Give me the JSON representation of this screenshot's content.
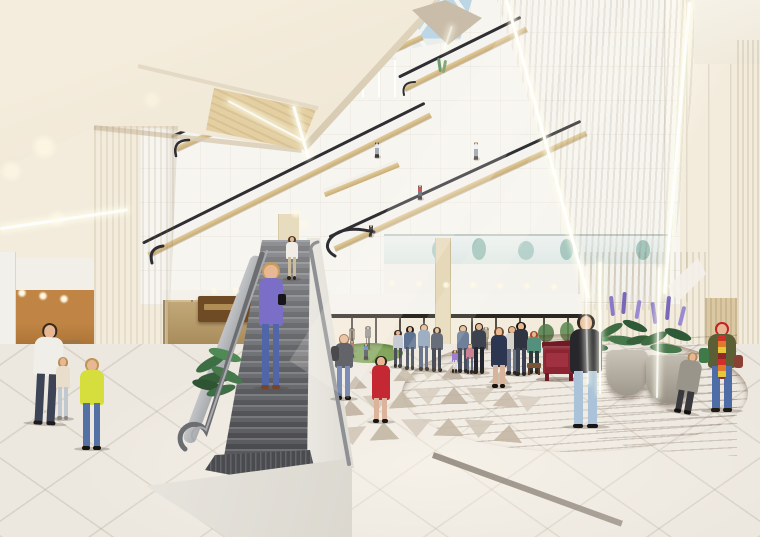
{
  "scene": {
    "type": "architectural-rendering",
    "subject": "shopping-mall-atrium-interior",
    "description": "Multi-storey mall atrium with skylight, criss-crossing escalators, central open staircase, tapering wood columns with LED strips, circular wood floor with red piano, planters with purple lupines, storefronts and shoppers",
    "palette": {
      "ceiling_cream": "#f0e8d8",
      "wall_white": "#f7f5f0",
      "wood_column": "#e0cda2",
      "wood_column_light": "#ead9b4",
      "escalator_gold": "#d9c291",
      "handrail_black": "#2f2f33",
      "stair_step_gray": "#5a5b60",
      "railing_gray": "#6b6d71",
      "floor_tile": "#ece7df",
      "triangle_taupe": "#c4b7a5",
      "wood_floor": "#9a6845",
      "piano_red": "#8c2431",
      "skylight_blue": "#bcd6e6",
      "plant_green": "#3e6b42",
      "flower_purple": "#8a7ac6",
      "led_white": "#ffffff"
    }
  },
  "people": [
    {
      "id": "balcony-person",
      "cx": 377,
      "hy": 142,
      "fy": 158,
      "top": "#e8ecee",
      "bottom": "#9aa4b0",
      "hair": "#3a332a",
      "o": 0.9
    },
    {
      "id": "escalator-person-dark",
      "cx": 371,
      "hy": 225,
      "fy": 237,
      "top": "#3c4250",
      "bottom": "#2c3038",
      "hair": "#20180f",
      "o": 0.9
    },
    {
      "id": "escalator-person-red",
      "cx": 420,
      "hy": 185,
      "fy": 200,
      "top": "#b02a30",
      "bottom": "#4e5668",
      "hair": "#2e2620",
      "o": 0.95
    },
    {
      "id": "escalator-person-white",
      "cx": 476,
      "hy": 142,
      "fy": 160,
      "top": "#eef0f2",
      "bottom": "#8a94a2",
      "hair": "#5a4a34",
      "o": 0.9
    },
    {
      "id": "store-fig-1",
      "cx": 352,
      "hy": 328,
      "fy": 352,
      "top": "#6a5a44",
      "bottom": "#3a342c",
      "hair": "#2a241c",
      "o": 0.55
    },
    {
      "id": "store-fig-2",
      "cx": 368,
      "hy": 326,
      "fy": 350,
      "top": "#44444c",
      "bottom": "#2e2a26",
      "hair": "#1e1a14",
      "o": 0.55
    },
    {
      "id": "store-fig-3",
      "cx": 486,
      "hy": 327,
      "fy": 350,
      "top": "#7a6a50",
      "bottom": "#4a4038",
      "hair": "#2c2016",
      "o": 0.5
    },
    {
      "id": "play-kid-1",
      "cx": 352,
      "hy": 341,
      "fy": 358,
      "top": "#c05a60",
      "bottom": "#5a6478",
      "hair": "#6a4a2a",
      "o": 0.9
    },
    {
      "id": "play-kid-2",
      "cx": 366,
      "hy": 344,
      "fy": 360,
      "top": "#5a80c0",
      "bottom": "#3e4454",
      "hair": "#3a2c1c",
      "o": 0.9
    },
    {
      "id": "crowd-1",
      "cx": 398,
      "hy": 330,
      "fy": 368,
      "top": "#c7ccd4",
      "bottom": "#4c505a",
      "hair": "#3a3027"
    },
    {
      "id": "crowd-2",
      "cx": 410,
      "hy": 326,
      "fy": 370,
      "top": "#5d7190",
      "bottom": "#3f4654",
      "hair": "#241e18"
    },
    {
      "id": "crowd-3",
      "cx": 424,
      "hy": 324,
      "fy": 371,
      "top": "#8fa2bc",
      "bottom": "#55607a",
      "hair": "#4a3b2a"
    },
    {
      "id": "crowd-4",
      "cx": 437,
      "hy": 327,
      "fy": 372,
      "top": "#4e5566",
      "bottom": "#2f333f",
      "hair": "#2c251d"
    },
    {
      "id": "crowd-kid-purple",
      "cx": 455,
      "hy": 350,
      "fy": 373,
      "top": "#9b80d2",
      "bottom": "#d9d9df",
      "hair": "#7a5a36"
    },
    {
      "id": "crowd-5",
      "cx": 463,
      "hy": 325,
      "fy": 373,
      "top": "#6e809a",
      "bottom": "#454d5e",
      "hair": "#1f1a14"
    },
    {
      "id": "crowd-kid-pink",
      "cx": 470,
      "hy": 344,
      "fy": 374,
      "top": "#c98291",
      "bottom": "#5b6579",
      "hair": "#8a6a42"
    },
    {
      "id": "crowd-6",
      "cx": 479,
      "hy": 323,
      "fy": 374,
      "top": "#3d424f",
      "bottom": "#23262e",
      "hair": "#2a2118"
    },
    {
      "id": "crowd-7",
      "cx": 512,
      "hy": 326,
      "fy": 375,
      "top": "#d6d3cc",
      "bottom": "#6b7284",
      "hair": "#5c4a30"
    },
    {
      "id": "crowd-8",
      "cx": 521,
      "hy": 322,
      "fy": 376,
      "top": "#2f3441",
      "bottom": "#3a4252",
      "hair": "#171310"
    },
    {
      "id": "woman-navy-skirt",
      "cx": 499,
      "hy": 327,
      "fy": 388,
      "top": "#2c3650",
      "bottom": "#d9b49a",
      "hair": "#6b4a2e",
      "shoe": "#14110e",
      "dress": true,
      "w": 18
    },
    {
      "id": "pianist",
      "cx": 534,
      "hy": 331,
      "fy": 374,
      "top": "#55907c",
      "bottom": "#2e3a3a",
      "hair": "#a34a28",
      "w": 15
    },
    {
      "id": "red-piano",
      "type": "piano",
      "x": 542,
      "y": 341,
      "w": 34,
      "body": "#8c2431",
      "dark": "#6e1b26",
      "front": "#a23344",
      "bench": "#7a5436"
    },
    {
      "id": "boy-backpack",
      "cx": 344,
      "hy": 334,
      "fy": 400,
      "top": "#3b3f48",
      "bottom": "#5a72a4",
      "hair": "#8a5f38",
      "shoe": "#15120e",
      "w": 20,
      "acc": [
        {
          "x": -3,
          "y": 12,
          "w": 8,
          "h": 15,
          "c": "#1d1d22",
          "r": 3
        }
      ]
    },
    {
      "id": "girl-red-dress",
      "cx": 381,
      "hy": 356,
      "fy": 423,
      "top": "#c32833",
      "bottom": "#dcb49c",
      "hair": "#2c2420",
      "shoe": "#1a1512",
      "dress": true,
      "w": 20
    },
    {
      "id": "stair-top-man",
      "cx": 292,
      "hy": 236,
      "fy": 280,
      "top": "#efede6",
      "bottom": "#cbbd9b",
      "hair": "#4a3a28",
      "shoe": "#2a2520"
    },
    {
      "id": "stair-woman-purple",
      "cx": 271,
      "hy": 262,
      "fy": 389,
      "top": "#7a6ec6",
      "bottom": "#5066a8",
      "hair": "#c79b5e",
      "shoe": "#76452c",
      "w": 26,
      "acc": [
        {
          "x": 20,
          "y": 32,
          "w": 8,
          "h": 11,
          "c": "#17151a",
          "r": 2
        }
      ]
    },
    {
      "id": "man-white-shirt",
      "cx": 47,
      "hy": 323,
      "fy": 425,
      "top": "#f0eee8",
      "bottom": "#3c4456",
      "hair": "#35291f",
      "shoe": "#1e1c1a",
      "tilt": 3
    },
    {
      "id": "toddler-beige",
      "cx": 63,
      "hy": 357,
      "fy": 420,
      "top": "#e8decb",
      "bottom": "#c2c8d0",
      "hair": "#b98e55",
      "shoe": "#8a8580",
      "w": 16
    },
    {
      "id": "girl-yellow-top",
      "cx": 92,
      "hy": 358,
      "fy": 450,
      "top": "#d6de3e",
      "bottom": "#5371a4",
      "hair": "#c09552",
      "shoe": "#17140f",
      "w": 26
    },
    {
      "id": "man-black-sweater",
      "cx": 586,
      "hy": 314,
      "fy": 428,
      "top": "#26262b",
      "bottom": "#aac3d8",
      "hair": "#27211c",
      "shoe": "#17151a",
      "w": 34
    },
    {
      "id": "puffer-child",
      "cx": 688,
      "hy": 352,
      "fy": 414,
      "top": "#9a958b",
      "bottom": "#3a3a3e",
      "hair": "#b08850",
      "shoe": "#14120f",
      "dress": true,
      "w": 24,
      "tilt": 10
    },
    {
      "id": "scarf-woman",
      "cx": 722,
      "hy": 322,
      "fy": 412,
      "top": "#5c5e36",
      "bottom": "#4e6ca6",
      "hair": "#3a2a1c",
      "hat": "#c21f26",
      "shoe": "#201a14",
      "w": 30,
      "scarf": true,
      "acc": [
        {
          "x": -8,
          "y": 26,
          "w": 10,
          "h": 15,
          "c": "#3f7a48",
          "r": 3
        },
        {
          "x": 27,
          "y": 33,
          "w": 9,
          "h": 13,
          "c": "#8a4034",
          "r": 3
        }
      ]
    }
  ],
  "escalators": [
    {
      "id": "escalator-upper",
      "x1": 178,
      "y1": 152,
      "x2": 424,
      "y2": 40
    },
    {
      "id": "escalator-top-right",
      "x1": 406,
      "y1": 92,
      "x2": 528,
      "y2": 32
    },
    {
      "id": "balcony-gold-edge",
      "x1": 326,
      "y1": 198,
      "x2": 400,
      "y2": 168,
      "thin": true
    },
    {
      "id": "escalator-mid",
      "x1": 150,
      "y1": 258,
      "x2": 432,
      "y2": 118
    },
    {
      "id": "escalator-lower",
      "x1": 336,
      "y1": 252,
      "x2": 588,
      "y2": 136
    }
  ],
  "triangles": [
    {
      "x": 298,
      "y": 412,
      "w": 26,
      "h": 16,
      "d": 1,
      "c": "#c9bcab",
      "r": -6
    },
    {
      "x": 324,
      "y": 406,
      "w": 26,
      "h": 16,
      "d": -1,
      "c": "#d8cec0",
      "r": -5
    },
    {
      "x": 350,
      "y": 400,
      "w": 27,
      "h": 16,
      "d": 1,
      "c": "#bfb2a0",
      "r": -5
    },
    {
      "x": 376,
      "y": 395,
      "w": 27,
      "h": 17,
      "d": -1,
      "c": "#d2c7b8",
      "r": -4
    },
    {
      "x": 402,
      "y": 391,
      "w": 28,
      "h": 17,
      "d": 1,
      "c": "#c4b7a5",
      "r": -3
    },
    {
      "x": 428,
      "y": 388,
      "w": 28,
      "h": 17,
      "d": -1,
      "c": "#d7cdbf",
      "r": -2
    },
    {
      "x": 454,
      "y": 387,
      "w": 28,
      "h": 17,
      "d": 1,
      "c": "#c0b2a0",
      "r": 0
    },
    {
      "x": 480,
      "y": 388,
      "w": 28,
      "h": 17,
      "d": -1,
      "c": "#d3c8b9",
      "r": 2
    },
    {
      "x": 506,
      "y": 391,
      "w": 27,
      "h": 16,
      "d": 1,
      "c": "#c7baa8",
      "r": 4
    },
    {
      "x": 528,
      "y": 396,
      "w": 26,
      "h": 16,
      "d": -1,
      "c": "#d8cfc1",
      "r": 6
    },
    {
      "x": 332,
      "y": 382,
      "w": 22,
      "h": 13,
      "d": -1,
      "c": "#cfc3b3",
      "r": -5
    },
    {
      "x": 356,
      "y": 376,
      "w": 22,
      "h": 13,
      "d": 1,
      "c": "#bdafa0",
      "r": -4
    },
    {
      "x": 380,
      "y": 371,
      "w": 23,
      "h": 13,
      "d": -1,
      "c": "#d5cabb",
      "r": -3
    },
    {
      "x": 404,
      "y": 367,
      "w": 23,
      "h": 14,
      "d": 1,
      "c": "#c2b4a2",
      "r": -2
    },
    {
      "x": 428,
      "y": 365,
      "w": 23,
      "h": 14,
      "d": -1,
      "c": "#d4c9ba",
      "r": 0
    },
    {
      "x": 452,
      "y": 365,
      "w": 23,
      "h": 14,
      "d": 1,
      "c": "#bfb19f",
      "r": 1
    },
    {
      "x": 476,
      "y": 367,
      "w": 23,
      "h": 13,
      "d": -1,
      "c": "#d2c6b6",
      "r": 3
    },
    {
      "x": 500,
      "y": 371,
      "w": 22,
      "h": 13,
      "d": 1,
      "c": "#c6b8a6",
      "r": 5
    },
    {
      "x": 352,
      "y": 427,
      "w": 30,
      "h": 18,
      "d": -1,
      "c": "#d0c5b6",
      "r": -4
    },
    {
      "x": 384,
      "y": 422,
      "w": 30,
      "h": 18,
      "d": 1,
      "c": "#c2b5a3",
      "r": -3
    },
    {
      "x": 416,
      "y": 419,
      "w": 31,
      "h": 18,
      "d": -1,
      "c": "#d6ccbe",
      "r": -1
    },
    {
      "x": 448,
      "y": 418,
      "w": 31,
      "h": 18,
      "d": 1,
      "c": "#c5b7a5",
      "r": 1
    },
    {
      "x": 479,
      "y": 420,
      "w": 30,
      "h": 18,
      "d": -1,
      "c": "#d2c7b8",
      "r": 3
    },
    {
      "x": 508,
      "y": 425,
      "w": 29,
      "h": 17,
      "d": 1,
      "c": "#c3b5a3",
      "r": 5
    }
  ],
  "leds": [
    {
      "x1": 506,
      "y1": 0,
      "x2": 588,
      "y2": 298,
      "t": 3,
      "o": 1
    },
    {
      "x1": 689,
      "y1": 2,
      "x2": 664,
      "y2": 294,
      "t": 2.5,
      "o": 0.95
    },
    {
      "x1": 600,
      "y1": 262,
      "x2": 600,
      "y2": 394,
      "t": 2.5,
      "o": 0.95
    },
    {
      "x1": 659,
      "y1": 268,
      "x2": 657,
      "y2": 398,
      "t": 2,
      "o": 0.9
    },
    {
      "x1": 585,
      "y1": 266,
      "x2": 588,
      "y2": 384,
      "t": 1.8,
      "o": 0.7
    },
    {
      "x1": 293,
      "y1": 106,
      "x2": 308,
      "y2": 158,
      "t": 3,
      "o": 0.95
    },
    {
      "x1": 228,
      "y1": 101,
      "x2": 302,
      "y2": 140,
      "t": 2.2,
      "o": 0.9
    },
    {
      "x1": 0,
      "y1": 229,
      "x2": 128,
      "y2": 210,
      "t": 2.5,
      "o": 0.9
    },
    {
      "x1": 444,
      "y1": 50,
      "x2": 452,
      "y2": 26,
      "t": 2,
      "o": 0.7
    }
  ],
  "lights": [
    {
      "x": 44,
      "y": 147,
      "r": 7,
      "o": 0.8
    },
    {
      "x": 11,
      "y": 171,
      "r": 6,
      "o": 0.7
    },
    {
      "x": 57,
      "y": 219,
      "r": 5,
      "o": 0.6
    },
    {
      "x": 152,
      "y": 100,
      "r": 5,
      "o": 0.5
    },
    {
      "x": 296,
      "y": 213,
      "r": 3,
      "o": 0.7
    },
    {
      "x": 304,
      "y": 224,
      "r": 2.5,
      "o": 0.7
    },
    {
      "x": 392,
      "y": 283,
      "r": 2.2,
      "o": 0.9
    },
    {
      "x": 419,
      "y": 284,
      "r": 2.2,
      "o": 0.9
    },
    {
      "x": 446,
      "y": 285,
      "r": 2.2,
      "o": 0.9
    },
    {
      "x": 473,
      "y": 285,
      "r": 2.2,
      "o": 0.9
    },
    {
      "x": 500,
      "y": 286,
      "r": 2.2,
      "o": 0.9
    },
    {
      "x": 527,
      "y": 286,
      "r": 2.2,
      "o": 0.9
    },
    {
      "x": 554,
      "y": 287,
      "r": 2.2,
      "o": 0.9
    },
    {
      "x": 22,
      "y": 293,
      "r": 2.5,
      "o": 1
    },
    {
      "x": 43,
      "y": 296,
      "r": 2.5,
      "o": 1
    },
    {
      "x": 64,
      "y": 299,
      "r": 2.5,
      "o": 1
    },
    {
      "x": 214,
      "y": 291,
      "r": 2,
      "o": 0.9
    },
    {
      "x": 236,
      "y": 291,
      "r": 2,
      "o": 0.9
    }
  ]
}
